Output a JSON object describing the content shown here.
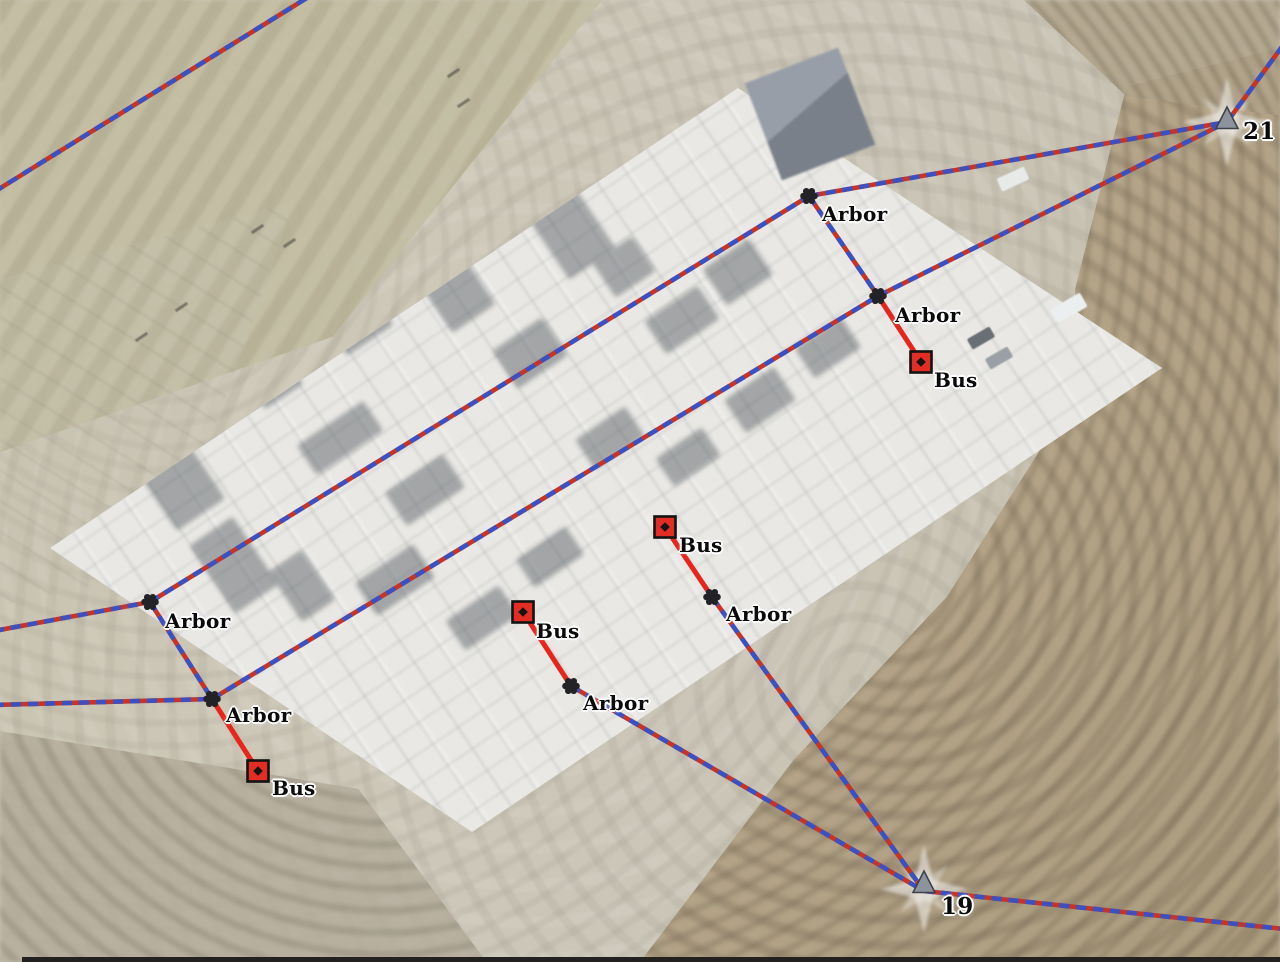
{
  "features": {
    "arbors": [
      {
        "label": "Arbor",
        "x": 809,
        "y": 196
      },
      {
        "label": "Arbor",
        "x": 878,
        "y": 296
      },
      {
        "label": "Arbor",
        "x": 150,
        "y": 602
      },
      {
        "label": "Arbor",
        "x": 212,
        "y": 699
      },
      {
        "label": "Arbor",
        "x": 571,
        "y": 686
      },
      {
        "label": "Arbor",
        "x": 712,
        "y": 597
      }
    ],
    "buses": [
      {
        "label": "Bus",
        "x": 921,
        "y": 362
      },
      {
        "label": "Bus",
        "x": 258,
        "y": 771
      },
      {
        "label": "Bus",
        "x": 523,
        "y": 612
      },
      {
        "label": "Bus",
        "x": 665,
        "y": 527
      }
    ],
    "junction_structures": [
      {
        "label": "21",
        "x": 1227,
        "y": 122
      },
      {
        "label": "19",
        "x": 924,
        "y": 889
      }
    ]
  },
  "colors": {
    "transmission_line_blue": "#3b50c1",
    "transmission_line_red": "#c63428",
    "bus_connector_red": "#e8251c",
    "arbor_node": "#232327",
    "bus_marker_fill": "#e12d24",
    "bus_marker_outline": "#121212",
    "structure_triangle_gray": "#8d939d",
    "label_text": "#0a0a0a",
    "label_halo": "#ffffff"
  }
}
